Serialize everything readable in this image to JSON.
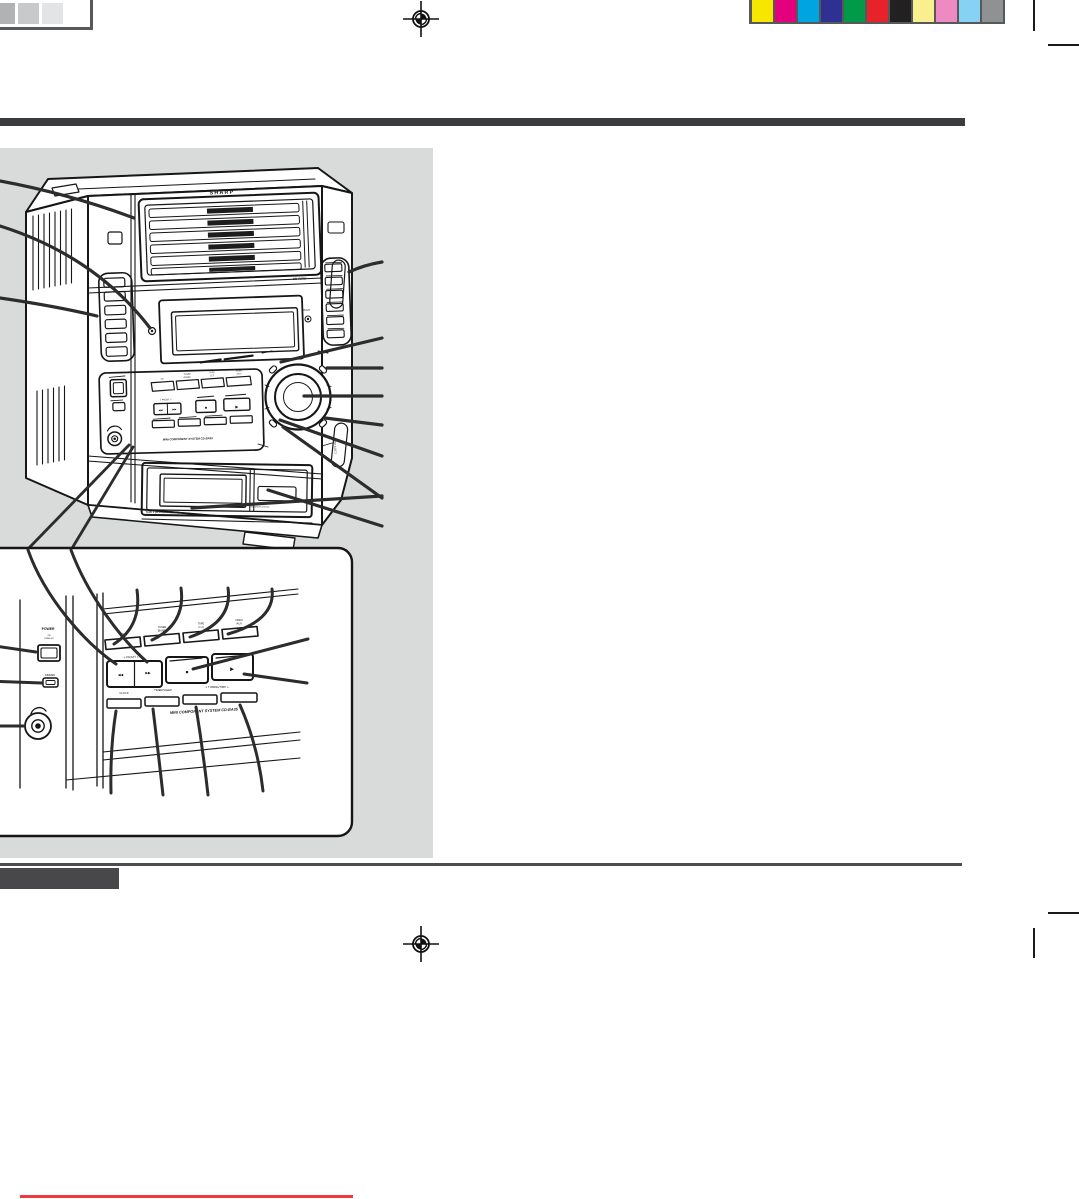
{
  "page": {
    "width": 1079,
    "height": 1199,
    "background": "#ffffff"
  },
  "print_marks": {
    "grayscale_swatches": [
      "#b0b2b3",
      "#c7c9ca",
      "#e3e4e5",
      "#ffffff"
    ],
    "color_swatches": [
      "#f7e600",
      "#e4007d",
      "#00a4e0",
      "#2e3192",
      "#009a48",
      "#e7222b",
      "#232021",
      "#f9ef8f",
      "#ef89c2",
      "#85d2f4",
      "#8f9193"
    ],
    "strip_border_color": "#57585a",
    "crop_mark_color": "#1a1a1a"
  },
  "bars": {
    "top_bar_color": "#3b3c3e",
    "section_rule_color": "#4c4d4f",
    "section_tab_color": "#48484a"
  },
  "figure": {
    "panel_background": "#d9dada",
    "ink_color": "#161616",
    "callout_color": "#2c2c2c",
    "brand": "SHARP",
    "labels": {
      "cd_rw": "CD-R/RW",
      "multi": "MULTI",
      "push_eject": "PUSH EJECT",
      "tape_door": "TAPE 1 (PLAYBACK/EJECT)",
      "record_playback": "RECORD/PLAYBACK",
      "system_name": "MINI COMPONENT SYSTEM CD-BA35",
      "power": "POWER",
      "on_standby_1": "ON/",
      "on_standby_2": "STAND-BY",
      "dimmer": "DIMMER",
      "func_cd": "CD",
      "func_tuner_1": "TUNER",
      "func_tuner_2": "(BAND)",
      "func_tape_1": "TAPE",
      "func_tape_2": "(1  2)",
      "func_video_1": "VIDEO",
      "func_video_2": "/AUX",
      "preset_row": "∨ PRESET ∧",
      "clock": "CLOCK",
      "timer_sleep": "TIMER/SLEEP",
      "tuning_time": "∨ TUNING/TIME ∧"
    },
    "glyphs": {
      "rew": "◀◀",
      "ffwd": "▶▶",
      "stop": "■",
      "play": "▶"
    }
  },
  "footer": {
    "red_line_color": "#ee3a3e"
  }
}
